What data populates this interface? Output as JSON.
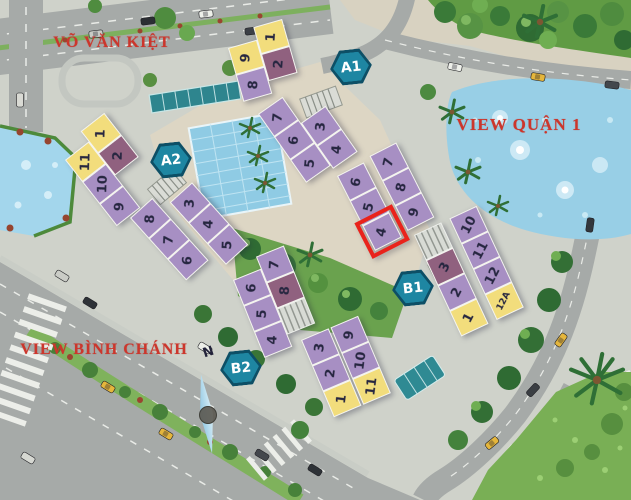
{
  "labels": {
    "vo_van_kiet": "VÕ VĂN KIỆT",
    "view_quan_1": "VIEW QUẬN 1",
    "view_binh_chanh": "VIEW BÌNH CHÁNH"
  },
  "compass": {
    "label": "N"
  },
  "badges": [
    {
      "id": "A1",
      "label": "A1"
    },
    {
      "id": "A2",
      "label": "A2"
    },
    {
      "id": "B1",
      "label": "B1"
    },
    {
      "id": "B2",
      "label": "B2"
    }
  ],
  "highlighted_unit": {
    "block": "B1",
    "unit": "4"
  },
  "colors": {
    "unit_yellow": "#f2dd7c",
    "unit_purple": "#a78fc3",
    "unit_dark_mauve": "#90617f",
    "highlight_red": "#e9231b",
    "badge_teal": "#1e86a2",
    "badge_border": "#0d4f66",
    "street_label_red": "#cc362c",
    "pool_blue": "#8fcbe4",
    "lake_blue": "#98cfe6"
  },
  "blocks": [
    {
      "id": "A1-upper",
      "block": "A1",
      "rows": [
        [
          {
            "n": "9",
            "c": "y"
          },
          {
            "n": "1",
            "c": "y"
          }
        ],
        [
          {
            "n": "8",
            "c": "p"
          },
          {
            "n": "2",
            "c": "d"
          }
        ]
      ]
    },
    {
      "id": "A1-lower",
      "block": "A1",
      "rows": [
        [
          {
            "n": "7",
            "c": "p"
          },
          null
        ],
        [
          {
            "n": "6",
            "c": "p"
          },
          {
            "n": "3",
            "c": "p"
          }
        ],
        [
          {
            "n": "5",
            "c": "p"
          },
          {
            "n": "4",
            "c": "p"
          }
        ]
      ]
    },
    {
      "id": "A2-upper",
      "block": "A2",
      "rows": [
        [
          {
            "n": "11",
            "c": "y"
          },
          {
            "n": "1",
            "c": "y"
          }
        ],
        [
          {
            "n": "10",
            "c": "p"
          },
          {
            "n": "2",
            "c": "d"
          }
        ],
        [
          {
            "n": "9",
            "c": "p"
          },
          null
        ]
      ]
    },
    {
      "id": "A2-lower",
      "block": "A2",
      "rows": [
        [
          {
            "n": "8",
            "c": "p"
          },
          {
            "n": "3",
            "c": "p"
          }
        ],
        [
          {
            "n": "7",
            "c": "p"
          },
          {
            "n": "4",
            "c": "p"
          }
        ],
        [
          {
            "n": "6",
            "c": "p"
          },
          {
            "n": "5",
            "c": "p"
          }
        ]
      ]
    },
    {
      "id": "B2-upper",
      "block": "B2",
      "rows": [
        [
          {
            "n": "6",
            "c": "p"
          },
          {
            "n": "7",
            "c": "p"
          }
        ],
        [
          {
            "n": "5",
            "c": "p"
          },
          {
            "n": "8",
            "c": "d"
          }
        ],
        [
          {
            "n": "4",
            "c": "p"
          },
          {
            "s": true
          }
        ]
      ]
    },
    {
      "id": "B2-lower",
      "block": "B2",
      "rows": [
        [
          {
            "n": "3",
            "c": "p"
          },
          {
            "n": "9",
            "c": "p"
          }
        ],
        [
          {
            "n": "2",
            "c": "p"
          },
          {
            "n": "10",
            "c": "p"
          }
        ],
        [
          {
            "n": "1",
            "c": "y"
          },
          {
            "n": "11",
            "c": "y"
          }
        ]
      ]
    },
    {
      "id": "B1-upper",
      "block": "B1",
      "rows": [
        [
          {
            "n": "6",
            "c": "p"
          },
          {
            "n": "7",
            "c": "p"
          }
        ],
        [
          {
            "n": "5",
            "c": "p"
          },
          {
            "n": "8",
            "c": "p"
          }
        ],
        [
          {
            "n": "4",
            "c": "p",
            "highlight": true
          },
          {
            "n": "9",
            "c": "p"
          }
        ]
      ]
    },
    {
      "id": "B1-lower",
      "block": "B1",
      "rows": [
        [
          {
            "s": true
          },
          {
            "n": "10",
            "c": "p"
          }
        ],
        [
          {
            "n": "3",
            "c": "d"
          },
          {
            "n": "11",
            "c": "p"
          }
        ],
        [
          {
            "n": "2",
            "c": "p"
          },
          {
            "n": "12",
            "c": "p"
          }
        ],
        [
          {
            "n": "1",
            "c": "y"
          },
          {
            "n": "12A",
            "c": "y"
          }
        ]
      ]
    }
  ]
}
